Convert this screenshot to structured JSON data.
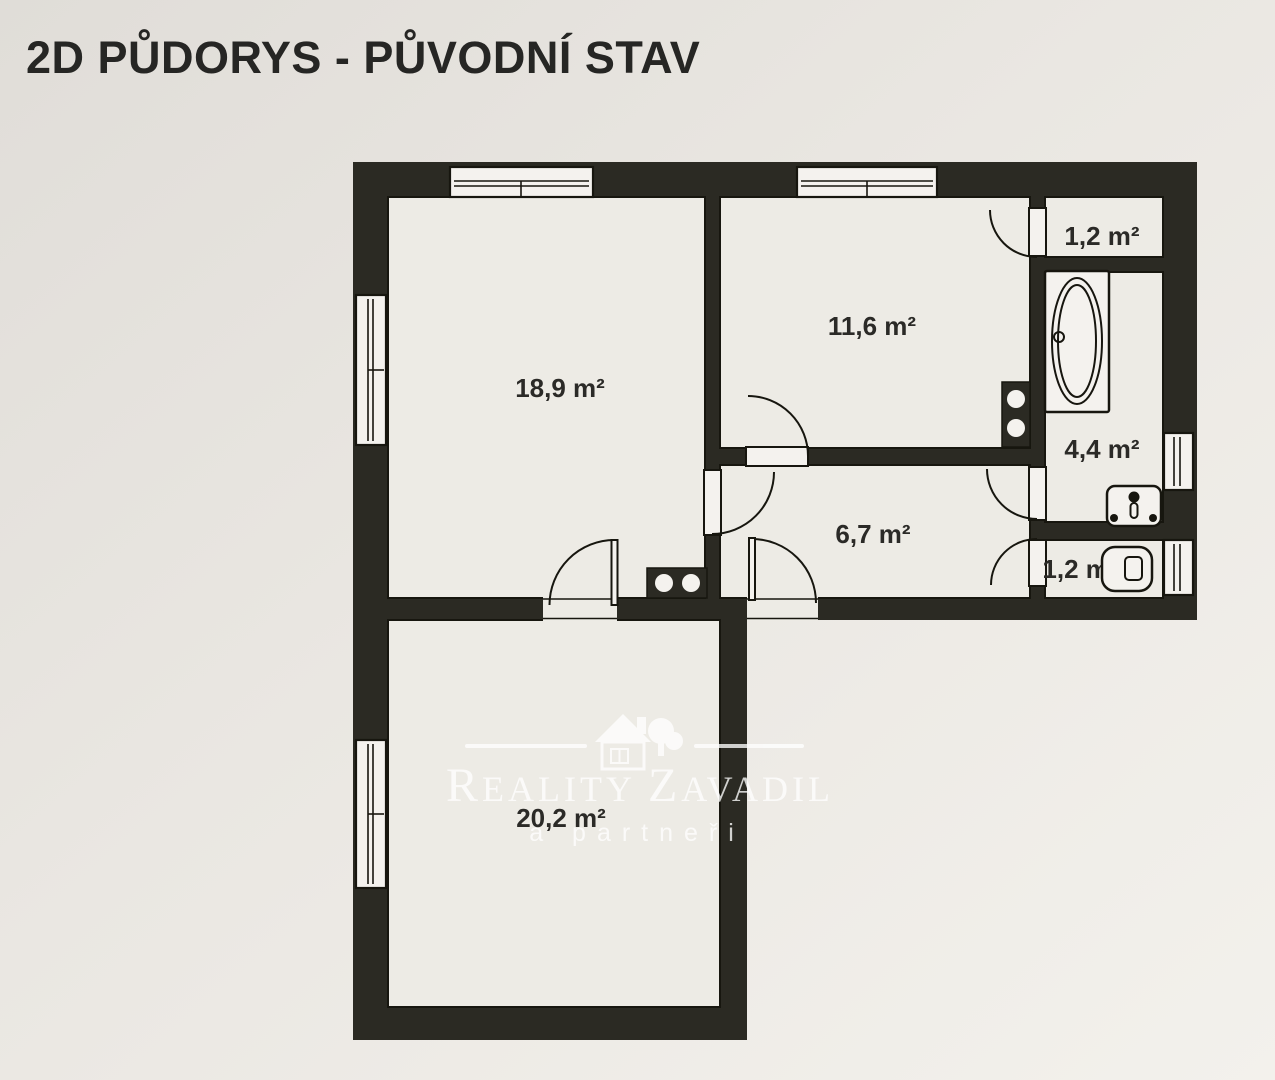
{
  "title": "2D PŮDORYS - PŮVODNÍ STAV",
  "plan": {
    "rooms": [
      {
        "name": "room-18-9",
        "area_label": "18,9 m²"
      },
      {
        "name": "room-11-6",
        "area_label": "11,6 m²"
      },
      {
        "name": "hallway-6-7",
        "area_label": "6,7 m²"
      },
      {
        "name": "closet-1-2",
        "area_label": "1,2 m²"
      },
      {
        "name": "bathroom-4-4",
        "area_label": "4,4 m²"
      },
      {
        "name": "wc-1-2",
        "area_label": "1,2 m²"
      },
      {
        "name": "room-20-2",
        "area_label": "20,2 m²"
      }
    ],
    "fixtures": [
      "bathtub",
      "sink",
      "toilet",
      "chimney-flues",
      "chimney-flues"
    ]
  },
  "watermark": {
    "brand_initial_1": "R",
    "brand_rest_1": "EALITY",
    "brand_initial_2": "Z",
    "brand_rest_2": "AVADIL",
    "tagline": "a partneři"
  },
  "colors": {
    "wall": "#2b2a23",
    "line": "#17160f",
    "paper_dark": "#e2dfda",
    "paper_light": "#f3f1ec",
    "room_fill": "#edebe5",
    "title_text": "#262624",
    "watermark": "#ffffff"
  }
}
